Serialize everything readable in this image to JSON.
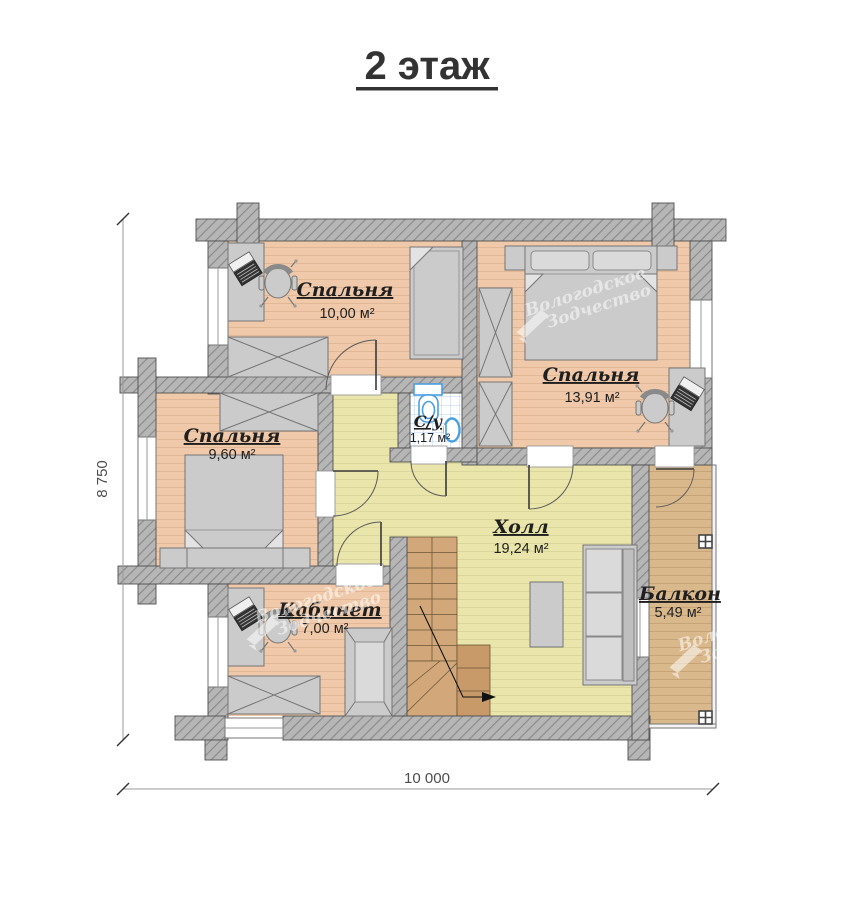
{
  "title": "2 этаж",
  "rooms": {
    "bedroom1": {
      "name": "Спальня",
      "area": "10,00 м²"
    },
    "bedroom2": {
      "name": "Спальня",
      "area": "13,91 м²"
    },
    "bedroom3": {
      "name": "Спальня",
      "area": "9,60 м²"
    },
    "bathroom": {
      "name": "С/у",
      "area": "1,17 м²"
    },
    "hall": {
      "name": "Холл",
      "area": "19,24 м²"
    },
    "office": {
      "name": "Кабинет",
      "area": "7,00 м²"
    },
    "balcony": {
      "name": "Балкон",
      "area": "5,49 м²"
    }
  },
  "dimensions": {
    "height_label": "8 750",
    "width_label": "10 000"
  },
  "watermark": {
    "line1": "Вологодское",
    "line2": "Зодчество"
  },
  "colors": {
    "wall": "#b6b6b6",
    "wall_hatch": "#8b8b8b",
    "bedroom_floor": "#efc9a9",
    "hall_floor": "#e9e5ab",
    "balcony_floor": "#d9b98c",
    "stairs": "#d2a87a",
    "stairs_dark": "#c89a69",
    "bath_tile": "#ffffff",
    "tile_line": "#b5d2ef",
    "fixture_blue": "#4a9fe0"
  }
}
